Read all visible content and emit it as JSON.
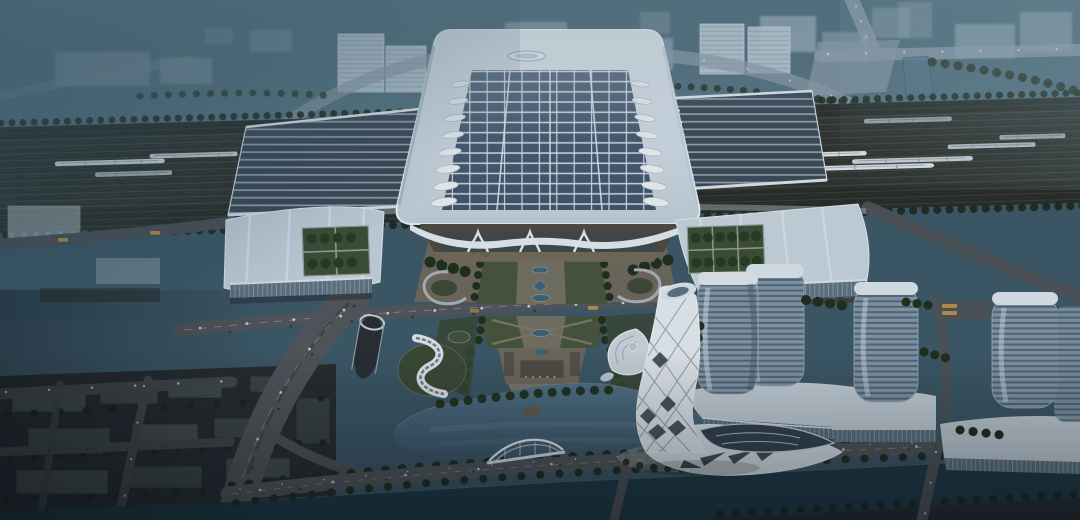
{
  "meta": {
    "title": "Aerial dusk rendering of a high-speed railway station complex",
    "media_type": "architectural visualization, no text or UI elements visible"
  },
  "scene": {
    "description": "Bird's-eye architectural rendering at dusk: a monumental railway station hall with a photovoltaic-panel roof and leaf-shaped skylights, flanked by long platform canopies over a rail yard with white high-speed trains; twin wing buildings with rooftop tree courtyards; a formal landscaped axis with reflecting pools and a gate pavilion leading to a lake with a white arched bridge; a twisted white lattice landmark tower with a flared diagrid base; a cluster of rounded glass towers on podium buildings; a tree-lined canal across the bottom; hazy city blocks fading into fog at the top.",
    "time_of_day": "dusk",
    "view": "aerial oblique",
    "setting": "urban waterfront rail district"
  },
  "colors": {
    "sky_top": "#42616e",
    "sky_low": "#5e7c8a",
    "fog": "#2c4a5a",
    "rail_bed": "#2e322c",
    "train_body": "#e3eaee",
    "station_roof_light": "#e6edf2",
    "station_roof_dark": "#c3d1db",
    "solar_panel": "#41546a",
    "panel_gap": "#d3dfe8",
    "canopy_panel": "#3c4956",
    "skylight_white": "#eff4f7",
    "wing_roof": "#c6d3dd",
    "courtyard_green": "#3c4e35",
    "tree_dark": "#202e1a",
    "glass_facade": "#5f7380",
    "plaza_paving": "#6e695c",
    "lawn": "#46543c",
    "pool_blue": "#3e6375",
    "road": "#51565a",
    "road_marking": "#8e979c",
    "lake_top": "#527287",
    "lake_deep": "#3a5667",
    "canal": "#1d3945",
    "bridge_white": "#edf2f5",
    "tower_glass": "#8499a8",
    "tower_cap": "#dde7ed",
    "podium_roof": "#cbd6de",
    "twist_tower_white": "#e7edf1",
    "twist_tower_glass": "#2c3c49",
    "block_dark": "#49534e",
    "bus_yellow": "#bd8f47"
  },
  "landmarks": [
    {
      "name": "central-station-hall",
      "label": "Central station hall with photovoltaic roof and oval emblem"
    },
    {
      "name": "platform-canopies",
      "label": "Solar-strip platform canopies flanking the hall"
    },
    {
      "name": "rail-yard",
      "label": "Rail yard with white high-speed trains"
    },
    {
      "name": "wing-buildings",
      "label": "Wing buildings with rooftop tree courtyards and glass facades"
    },
    {
      "name": "central-axis",
      "label": "Landscaped ceremonial axis with reflecting pools and gate pavilion"
    },
    {
      "name": "lake",
      "label": "Ornamental lake with arched pedestrian bridge"
    },
    {
      "name": "twisted-tower",
      "label": "Twisted white diagrid landmark tower with flared base"
    },
    {
      "name": "glass-tower-cluster",
      "label": "Rounded glass high-rise towers on podium buildings"
    },
    {
      "name": "s-curve-pavilion",
      "label": "S-curved white pavilion on a green mound"
    },
    {
      "name": "leaf-pavilion",
      "label": "Leaf-shaped domed pavilion"
    },
    {
      "name": "canal",
      "label": "Tree-lined canal along the bottom edge"
    },
    {
      "name": "city-background",
      "label": "Hazy city blocks and roads fading into dusk fog"
    },
    {
      "name": "residential-blocks",
      "label": "Dark low-rise blocks in the lower-left district"
    }
  ]
}
